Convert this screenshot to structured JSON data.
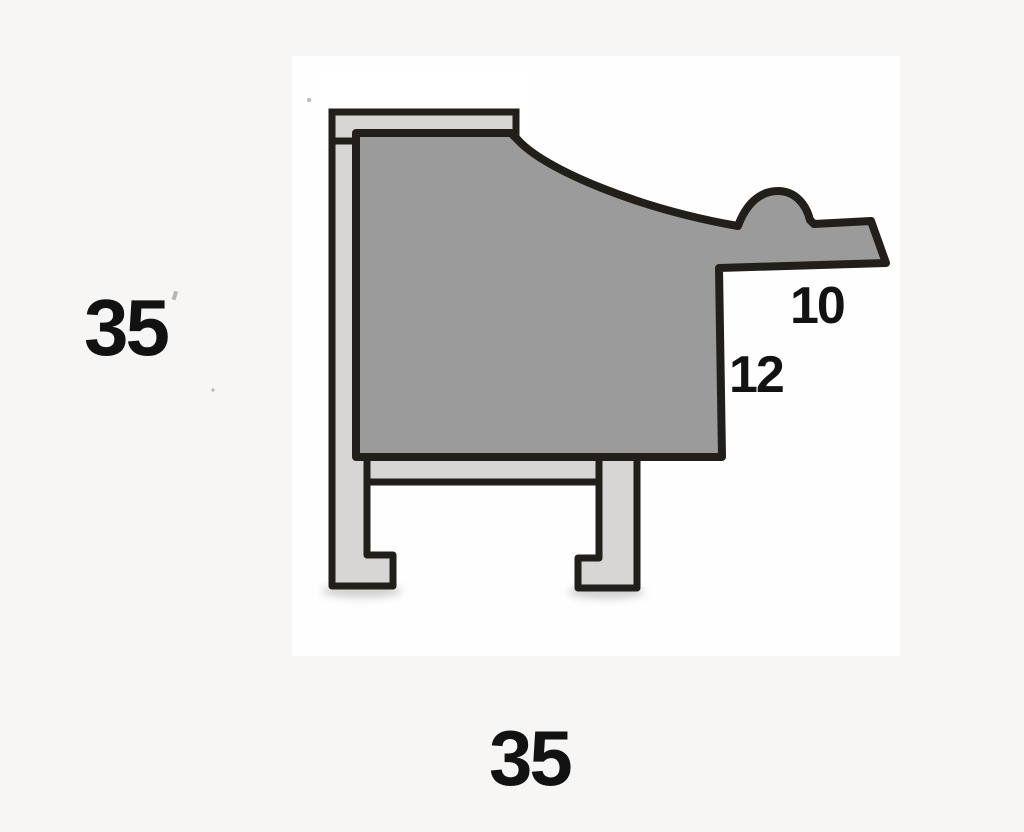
{
  "labels": {
    "left_height": "35",
    "bottom_width": "35",
    "upper_right": "10",
    "lower_right": "12"
  },
  "colors": {
    "background": "#f7f6f5",
    "paper": "#ffffff",
    "outline": "#221f1b",
    "face": "#9b9b9b",
    "metal": "#d7d6d5",
    "label": "#121212",
    "shadow": "#93908b",
    "speck": "#8f8b86"
  }
}
